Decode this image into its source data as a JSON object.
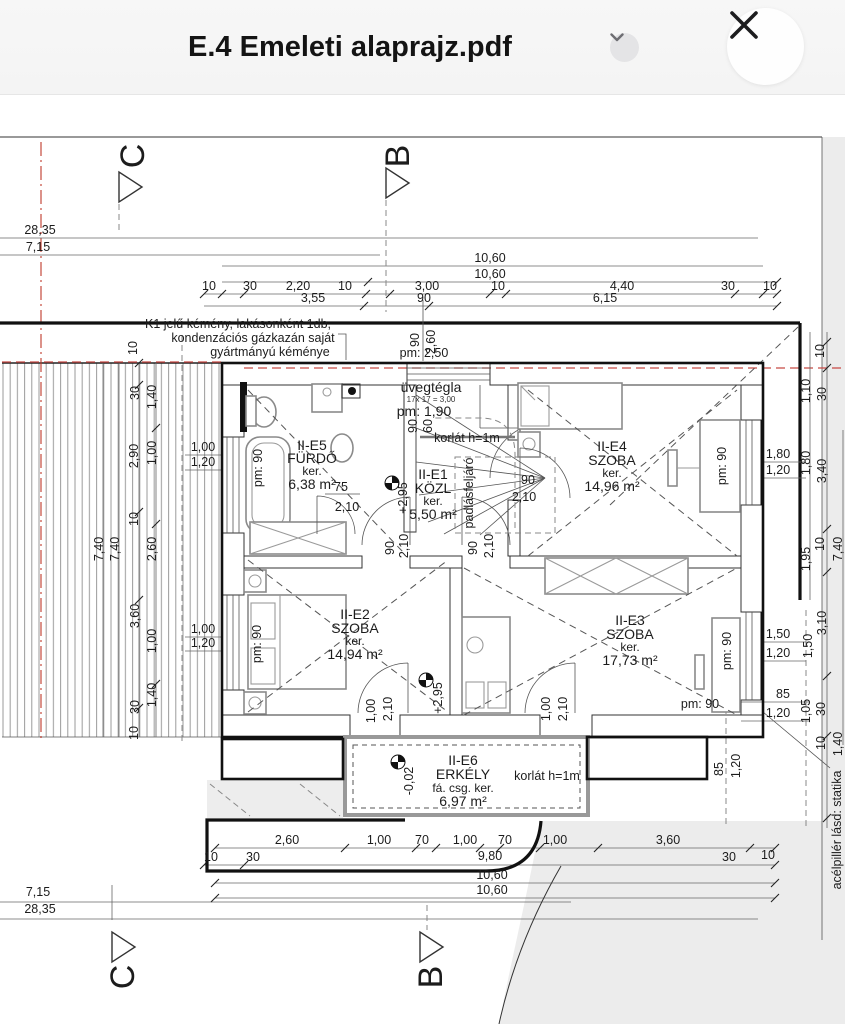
{
  "header": {
    "title": "E.4 Emeleti alaprajz.pdf",
    "chevron_icon": "chevron-down",
    "close_icon": "close-x"
  },
  "axes": {
    "c": "C",
    "b": "B"
  },
  "rooms": [
    {
      "id": "II-E5",
      "name": "FÜRDŐ",
      "line3": "ker.",
      "area": "6,38 m²"
    },
    {
      "id": "II-E1",
      "name": "KÖZL",
      "line3": "ker.",
      "area": "5,50 m²"
    },
    {
      "id": "II-E4",
      "name": "SZOBA",
      "line3": "ker.",
      "area": "14,96 m²"
    },
    {
      "id": "II-E2",
      "name": "SZOBA",
      "line3": "ker.",
      "area": "14,94 m²"
    },
    {
      "id": "II-E3",
      "name": "SZOBA",
      "line3": "ker.",
      "area": "17,73 m²"
    },
    {
      "id": "II-E6",
      "name": "ERKÉLY",
      "line3": "fá. csg. ker.",
      "area": "6,97 m²"
    }
  ],
  "notes": {
    "chimney1": "K1 jelű kémény, lakásonként 1db,",
    "chimney2": "kondenzációs gázkazán saját",
    "chimney3": "gyártmányú kéménye",
    "glass1": "üvegtégla",
    "glass2": "17x 17  = 3,00",
    "railing": "korlát h=1m",
    "attic": "padlásfeljáró",
    "steel": "acélpillér lásd: statika"
  },
  "vals": {
    "v10": "10",
    "v30": "30",
    "v60": "60",
    "v70": "70",
    "v75": "75",
    "v85": "85",
    "v90": "90",
    "v100": "1,00",
    "v105": "1,05",
    "v110": "1,10",
    "v120": "1,20",
    "v140": "1,40",
    "v150": "1,50",
    "v180": "1,80",
    "v195": "1,95",
    "v210": "2,10",
    "v220": "2,20",
    "v260": "2,60",
    "v290": "2,90",
    "v295": "+2,95",
    "vm002": "-0,02",
    "v300": "3,00",
    "v310": "3,10",
    "v340": "3,40",
    "v355": "3,55",
    "v360": "3,60",
    "v440": "4,40",
    "v615": "6,15",
    "v715": "7,15",
    "v740": "7,40",
    "v980": "9,80",
    "v1060": "10,60",
    "v2835": "28,35",
    "pm90": "pm: 90",
    "pm190": "pm: 1,90",
    "pm250": "pm: 2,50"
  },
  "colors": {
    "accent_red": "#c0392b",
    "page_gray": "#ececec",
    "header_bg": "#f6f6f6"
  }
}
